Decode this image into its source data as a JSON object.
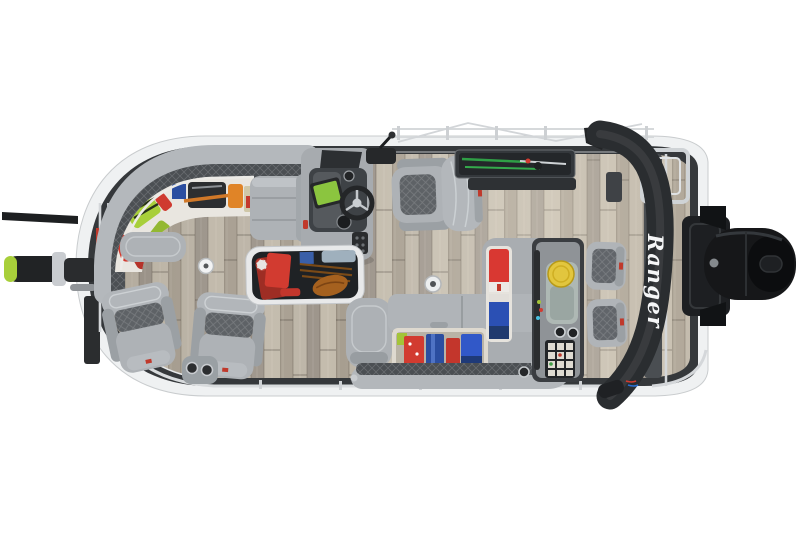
{
  "meta": {
    "width": 800,
    "height": 533,
    "background": "#ffffff",
    "alt": "Overhead top-down photo of a gray pontoon fishing boat: wraparound bow lounge with open storage full of colorful gear, two bow pedestal fishing chairs, helm console with fishfinder and captain's chair, in-floor rod locker, gunwale rod locker, aft L-shaped seating with open life-jacket storage, rear fishing station with yellow livewell lid and tackle trays, two rear jump seats, folded black bimini with Ranger logo, bow trolling motor and black outboard motor at the stern."
  },
  "branding": {
    "bimini_logo_text": "Ranger",
    "logo_color": "#f5f6f7"
  },
  "palette": {
    "background": "#ffffff",
    "hull_white": "#eff1f2",
    "gunwale_dark": "#35383b",
    "rail_silver": "#d7dadd",
    "floor_base": "#b2aa9d",
    "furniture_gray": "#aeb2b6",
    "furniture_deep": "#989da1",
    "trim_charcoal": "#4b4f53",
    "diamond_gray": "#5e6266",
    "tray_white": "#e9e6e0",
    "bimini_black": "#2a2d30",
    "motor_black": "#161719",
    "livewell_yellow": "#e2c63e",
    "screen_green": "#8bc53f",
    "rod_green": "#2f9e46",
    "gear_lime": "#a8cf3a",
    "gear_red": "#d23b30",
    "gear_orange": "#e08427",
    "gear_blue": "#2b4ea0",
    "gear_royal": "#3158c8",
    "badge_red": "#c0392b"
  }
}
